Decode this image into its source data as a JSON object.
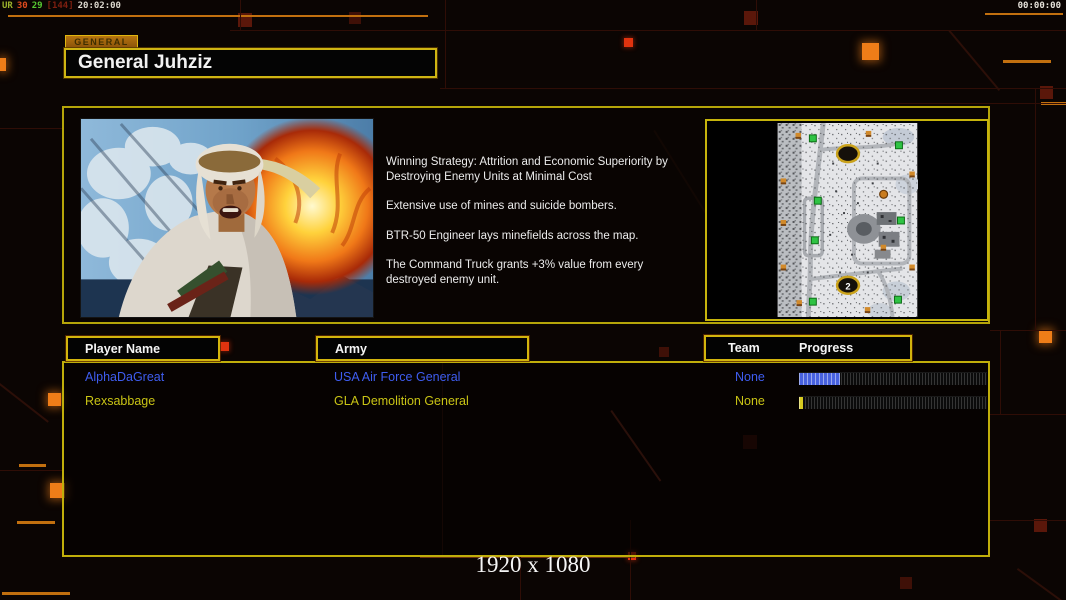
{
  "overlay": {
    "left": {
      "label": "UR",
      "fps": "30",
      "frametime": "29",
      "bracket": "[144]",
      "time": "20:02:00"
    },
    "right": {
      "time": "00:00:00"
    }
  },
  "general": {
    "tab_label": "GENERAL",
    "name": "General Juhziz",
    "strategy": [
      "Winning Strategy: Attrition and Economic Superiority by\n Destroying Enemy Units at Minimal Cost",
      "Extensive use of mines and suicide bombers.",
      "BTR-50 Engineer lays minefields across the map.",
      "The Command Truck grants +3% value from every\n destroyed enemy unit."
    ]
  },
  "map_preview": {
    "start_position_label": "2"
  },
  "players": {
    "headers": {
      "player_name": "Player Name",
      "army": "Army",
      "team": "Team",
      "progress": "Progress"
    },
    "rows": [
      {
        "name": "AlphaDaGreat",
        "army": "USA Air Force General",
        "team": "None",
        "progress_percent": 22,
        "text_color": "#3f5df0",
        "bar_color": "#4862e0"
      },
      {
        "name": "Rexsabbage",
        "army": "GLA Demolition General",
        "team": "None",
        "progress_percent": 2,
        "text_color": "#c9c415",
        "bar_color": "#d6ca20"
      }
    ]
  },
  "footer": {
    "resolution": "1920 x 1080"
  },
  "colors": {
    "background": "#0b0503",
    "panel_border": "#b5a509",
    "header_border": "#d3b50d",
    "accent_orange": "#ef7d18",
    "player1_blue": "#3f5df0",
    "player2_yellow": "#c9c415"
  }
}
